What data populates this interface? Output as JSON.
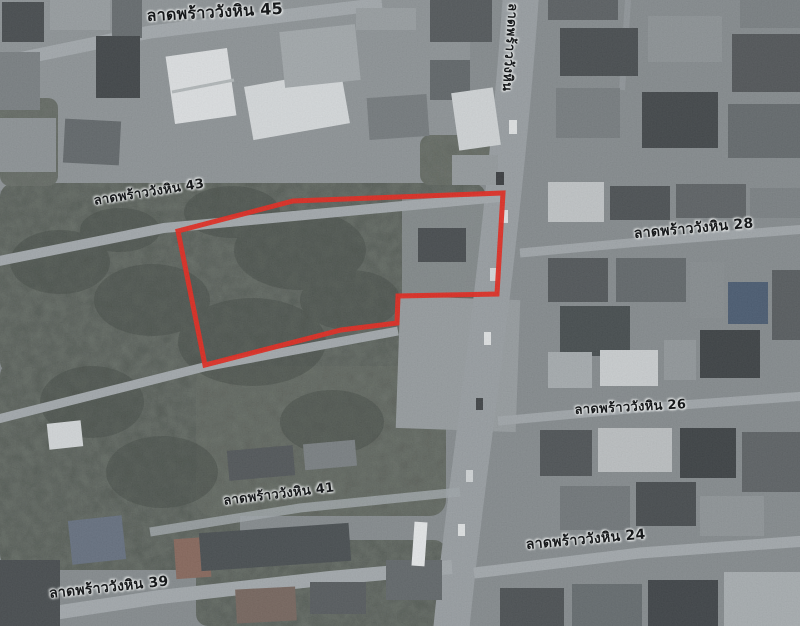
{
  "map": {
    "view": "satellite",
    "labels": [
      {
        "id": "soi-45",
        "text": "ลาดพร้าววังหิน 45",
        "x": 146,
        "y": 4,
        "rotate": -3,
        "size": 16
      },
      {
        "id": "soi-43",
        "text": "ลาดพร้าววังหิน 43",
        "x": 92,
        "y": 190,
        "rotate": -9,
        "size": 13
      },
      {
        "id": "road-lat-phrao-wang-hin",
        "text": "ลาดพร้าววังหิน",
        "x": 524,
        "y": 4,
        "rotate": 94,
        "size": 13
      },
      {
        "id": "soi-28",
        "text": "ลาดพร้าววังหิน 28",
        "x": 633,
        "y": 223,
        "rotate": -5,
        "size": 14
      },
      {
        "id": "soi-26",
        "text": "ลาดพร้าววังหิน 26",
        "x": 574,
        "y": 399,
        "rotate": -3,
        "size": 13
      },
      {
        "id": "soi-41",
        "text": "ลาดพร้าววังหิน 41",
        "x": 222,
        "y": 490,
        "rotate": -7,
        "size": 13
      },
      {
        "id": "soi-24",
        "text": "ลาดพร้าววังหิน 24",
        "x": 525,
        "y": 534,
        "rotate": -5,
        "size": 14
      },
      {
        "id": "soi-39",
        "text": "ลาดพร้าววังหิน 39",
        "x": 48,
        "y": 583,
        "rotate": -6,
        "size": 14
      }
    ],
    "plot_outline": {
      "color": "#dc1b11",
      "stroke_width": 5,
      "points": [
        [
          178,
          231
        ],
        [
          293,
          201
        ],
        [
          503,
          193
        ],
        [
          497,
          294
        ],
        [
          398,
          296
        ],
        [
          397,
          323
        ],
        [
          341,
          330
        ],
        [
          205,
          365
        ]
      ]
    },
    "palette": {
      "base_ground": "#7b8184",
      "trees": "#4a514b",
      "road": "#8f9599",
      "label_text": "#17191b",
      "label_halo": "#e8eaea"
    }
  }
}
